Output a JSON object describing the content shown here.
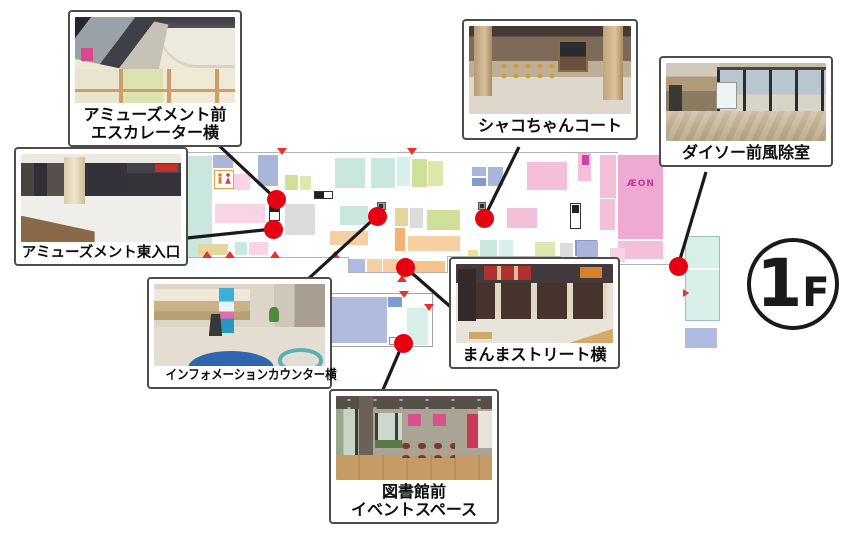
{
  "floor_badge": {
    "number": "1",
    "letter": "F"
  },
  "map": {
    "aeon_label": "ÆON",
    "marker_color": "#e60012",
    "line_color": "#1a1a1a",
    "palette": {
      "teal": "#c9e6df",
      "tealLight": "#d9efe9",
      "blue": "#a9b6da",
      "blueMed": "#7f9cd0",
      "periwinkle": "#b0bcdf",
      "pink": "#f4bfd9",
      "pinkLight": "#f9d4e4",
      "pinkAeon": "#eeaad2",
      "magenta": "#cc44aa",
      "green": "#cfe09a",
      "greenLight": "#dde8ad",
      "khaki": "#e3d79e",
      "peach": "#f6cfa2",
      "orange": "#f2b375",
      "orangeLight": "#f6c488",
      "gray": "#dcdcdc",
      "yellow": "#f0e394"
    },
    "blocks": [
      [
        186,
        156,
        26,
        102,
        "teal"
      ],
      [
        213,
        155,
        20,
        13,
        "blue"
      ],
      [
        233,
        174,
        17,
        16,
        "pinkLight"
      ],
      [
        258,
        155,
        20,
        31,
        "blue"
      ],
      [
        285,
        175,
        13,
        15,
        "green"
      ],
      [
        300,
        176,
        11,
        14,
        "greenLight"
      ],
      [
        215,
        204,
        50,
        19,
        "pinkLight"
      ],
      [
        285,
        204,
        30,
        31,
        "gray"
      ],
      [
        198,
        244,
        30,
        11,
        "khaki"
      ],
      [
        235,
        242,
        12,
        13,
        "teal"
      ],
      [
        249,
        242,
        19,
        13,
        "pinkLight"
      ],
      [
        335,
        158,
        30,
        30,
        "teal"
      ],
      [
        371,
        158,
        24,
        30,
        "teal"
      ],
      [
        397,
        157,
        13,
        29,
        "tealLight"
      ],
      [
        412,
        159,
        15,
        28,
        "green"
      ],
      [
        428,
        161,
        15,
        25,
        "greenLight"
      ],
      [
        472,
        167,
        14,
        9,
        "blue"
      ],
      [
        488,
        167,
        15,
        19,
        "blue"
      ],
      [
        472,
        178,
        14,
        8,
        "blueMed"
      ],
      [
        527,
        162,
        40,
        28,
        "pink"
      ],
      [
        340,
        206,
        28,
        19,
        "teal"
      ],
      [
        395,
        208,
        13,
        18,
        "khaki"
      ],
      [
        410,
        208,
        13,
        20,
        "gray"
      ],
      [
        427,
        210,
        33,
        20,
        "green"
      ],
      [
        507,
        208,
        30,
        20,
        "pink"
      ],
      [
        330,
        231,
        38,
        14,
        "peach"
      ],
      [
        395,
        228,
        10,
        23,
        "orange"
      ],
      [
        408,
        236,
        52,
        15,
        "peach"
      ],
      [
        480,
        240,
        17,
        16,
        "teal"
      ],
      [
        499,
        240,
        14,
        16,
        "tealLight"
      ],
      [
        535,
        242,
        20,
        14,
        "greenLight"
      ],
      [
        575,
        240,
        22,
        16,
        "blueMed"
      ],
      [
        560,
        243,
        13,
        15,
        "gray"
      ],
      [
        468,
        250,
        10,
        8,
        "yellow"
      ],
      [
        348,
        259,
        17,
        13,
        "periwinkle"
      ],
      [
        367,
        259,
        15,
        13,
        "peach"
      ],
      [
        383,
        259,
        15,
        13,
        "peach"
      ],
      [
        413,
        261,
        32,
        12,
        "orangeLight"
      ],
      [
        578,
        152,
        13,
        29,
        "pink"
      ],
      [
        582,
        155,
        7,
        10,
        "magenta"
      ],
      [
        600,
        155,
        16,
        43,
        "pink"
      ],
      [
        618,
        155,
        45,
        84,
        "pinkAeon"
      ],
      [
        600,
        199,
        15,
        31,
        "pink"
      ],
      [
        618,
        241,
        45,
        18,
        "pink"
      ],
      [
        577,
        241,
        21,
        17,
        "blue"
      ],
      [
        610,
        248,
        15,
        14,
        "pinkLight"
      ],
      [
        327,
        297,
        60,
        46,
        "periwinkle"
      ],
      [
        388,
        297,
        14,
        10,
        "blueMed"
      ],
      [
        407,
        308,
        21,
        37,
        "tealLight"
      ],
      [
        685,
        328,
        32,
        20,
        "periwinkle"
      ]
    ],
    "walls": [
      [
        185,
        152,
        433,
        1
      ],
      [
        185,
        152,
        1,
        106
      ],
      [
        185,
        257,
        164,
        1
      ],
      [
        348,
        257,
        1,
        16
      ],
      [
        348,
        272,
        100,
        1
      ],
      [
        447,
        256,
        1,
        17
      ],
      [
        447,
        256,
        113,
        1
      ],
      [
        560,
        256,
        1,
        9
      ],
      [
        560,
        264,
        119,
        1
      ]
    ],
    "triangles": [
      [
        277,
        148,
        "down"
      ],
      [
        407,
        148,
        "down"
      ],
      [
        202,
        251,
        "up"
      ],
      [
        225,
        251,
        "up"
      ],
      [
        270,
        251,
        "up"
      ],
      [
        330,
        251,
        "up"
      ],
      [
        397,
        275,
        "up"
      ],
      [
        399,
        291,
        "down"
      ],
      [
        424,
        304,
        "down"
      ],
      [
        683,
        289,
        "right"
      ]
    ],
    "dots": [
      [
        276,
        199
      ],
      [
        273,
        229
      ],
      [
        377,
        216
      ],
      [
        484,
        218
      ],
      [
        405,
        267
      ],
      [
        678,
        266
      ],
      [
        403,
        343
      ]
    ],
    "lines": [
      [
        213,
        140,
        276,
        199
      ],
      [
        187,
        238,
        273,
        229
      ],
      [
        519,
        147,
        484,
        218
      ],
      [
        706,
        172,
        678,
        266
      ],
      [
        307,
        280,
        377,
        216
      ],
      [
        453,
        309,
        405,
        267
      ],
      [
        382,
        392,
        403,
        343
      ]
    ]
  },
  "locations": [
    {
      "name": "amusement-escalator",
      "label_lines": [
        "アミューズメント前",
        "エスカレーター横"
      ]
    },
    {
      "name": "shako-chan-court",
      "label_lines": [
        "シャコちゃんコート"
      ]
    },
    {
      "name": "daiso-vestibule",
      "label_lines": [
        "ダイソー前風除室"
      ]
    },
    {
      "name": "amusement-east-entrance",
      "label_lines": [
        "アミューズメント東入口"
      ]
    },
    {
      "name": "information-counter",
      "label_lines": [
        "インフォメーションカウンター横"
      ]
    },
    {
      "name": "manma-street",
      "label_lines": [
        "まんまストリート横"
      ]
    },
    {
      "name": "library-event-space",
      "label_lines": [
        "図書館前",
        "イベントスペース"
      ]
    }
  ]
}
